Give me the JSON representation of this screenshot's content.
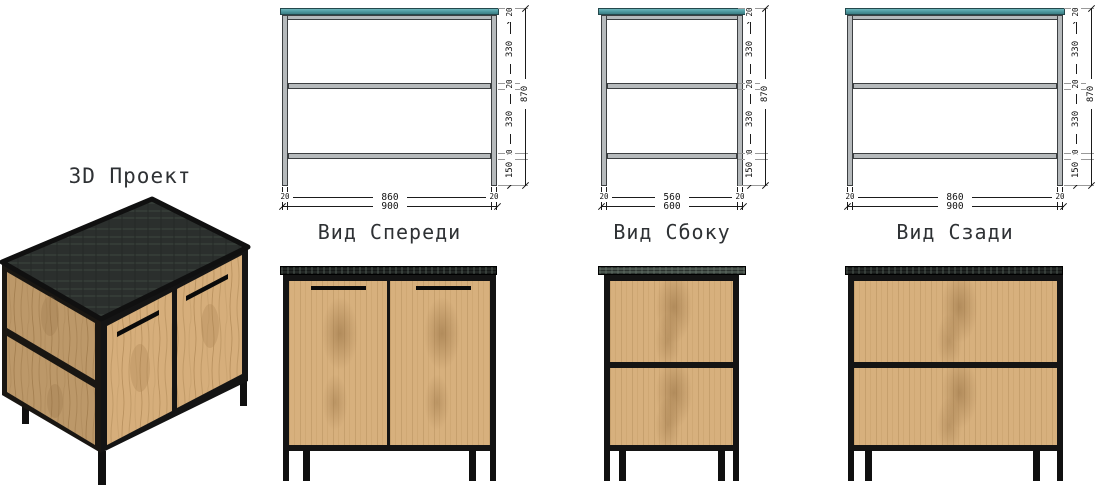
{
  "title_3d": "3D Проект",
  "views": {
    "front": {
      "label": "Вид Спереди",
      "seg_top": "20",
      "seg_a": "330",
      "seg_mid": "20",
      "seg_b": "330",
      "seg_low": "20",
      "seg_bottom": "150",
      "height_total": "870",
      "width_inner": "860",
      "width_outer": "900",
      "offset_left": "20",
      "offset_right": "20"
    },
    "side": {
      "label": "Вид Сбоку",
      "seg_top": "20",
      "seg_a": "330",
      "seg_mid": "20",
      "seg_b": "330",
      "seg_low": "20",
      "seg_bottom": "150",
      "height_total": "870",
      "width_inner": "560",
      "width_outer": "600",
      "offset_left": "20",
      "offset_right": "20"
    },
    "rear": {
      "label": "Вид Сзади",
      "seg_top": "20",
      "seg_a": "330",
      "seg_mid": "20",
      "seg_b": "330",
      "seg_low": "20",
      "seg_bottom": "150",
      "height_total": "870",
      "width_inner": "860",
      "width_outer": "900",
      "offset_left": "20",
      "offset_right": "20"
    }
  },
  "colors": {
    "countertop_teal": "#4c979d",
    "frame_steel_grey": "#b6babc",
    "metal_black": "#141414",
    "wood": "#d7b07d",
    "dark_top": "#222624",
    "dim_line": "#1b1b1b",
    "label_text": "#2e3134"
  }
}
